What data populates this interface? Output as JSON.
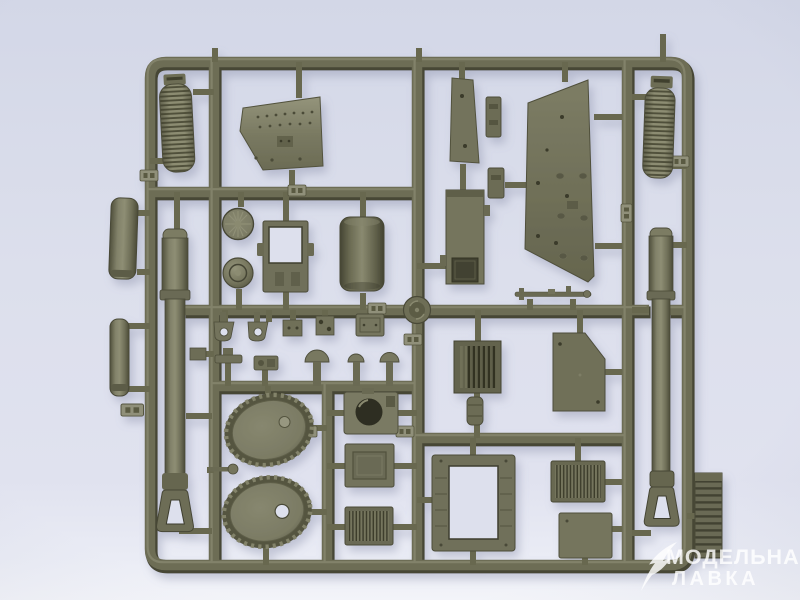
{
  "scene": {
    "type": "photograph",
    "subject": "Olive-drab injection-molded plastic model-kit sprue (parts tree) for an armored vehicle kit, photographed on a pale blue-grey background",
    "frame": "rectangular sprue frame with interior runners; parts attached by thin gates; small embossed part-number tabs on the runners",
    "lighting": "soft daylight, subtle shadow below-right of the plastic, brighter band along the bottom edge"
  },
  "watermark": {
    "line1": "МОДЕЛЬНАЯ",
    "line2": "ЛАВКА",
    "icon": "quill-icon",
    "color": "#ffffff"
  },
  "colors": {
    "bg_top": "#d4d8e8",
    "bg_mid": "#dde0ed",
    "bg_low": "#e4e6f1",
    "bg_bottom": "#f3f4f9",
    "plastic_mid": "#6d6d55",
    "plastic_light": "#8f8f76",
    "plastic_dark": "#4a4a37",
    "plastic_deep": "#323224",
    "plastic_face": "#7b7b63",
    "shadow_color": "#7f85a3",
    "watermark_color": "#ffffff"
  },
  "parts": [
    "ribbed cylinder (top left)",
    "riveted glacis plate",
    "narrow side plate with holes",
    "large hull side plate with holes and recesses",
    "ribbed cylinder (top right)",
    "short recoil cylinder (left edge)",
    "long recoil cylinder (left edge)",
    "gun barrel with muzzle brake (left)",
    "spoked idler wheel",
    "dome wheel hub",
    "hatch frame with open window",
    "mantlet drum",
    "round hatch ring at runner crossing",
    "superstructure box with square hatch opening",
    "towing rod with fittings",
    "tow shackle x2",
    "small bracket plates x3",
    "clamp and small boxes",
    "periscope mushrooms x3",
    "louvered box",
    "angled side plate",
    "small post",
    "drive sprocket wheel x2",
    "pin rod with ball end",
    "square plate with round hatch hole",
    "recessed access panel",
    "louvered panel",
    "engine hatch frame",
    "radiator grille panel",
    "flat access plate",
    "gun barrel with muzzle brake (right)",
    "track section outside frame",
    "embossed part-number tabs"
  ]
}
